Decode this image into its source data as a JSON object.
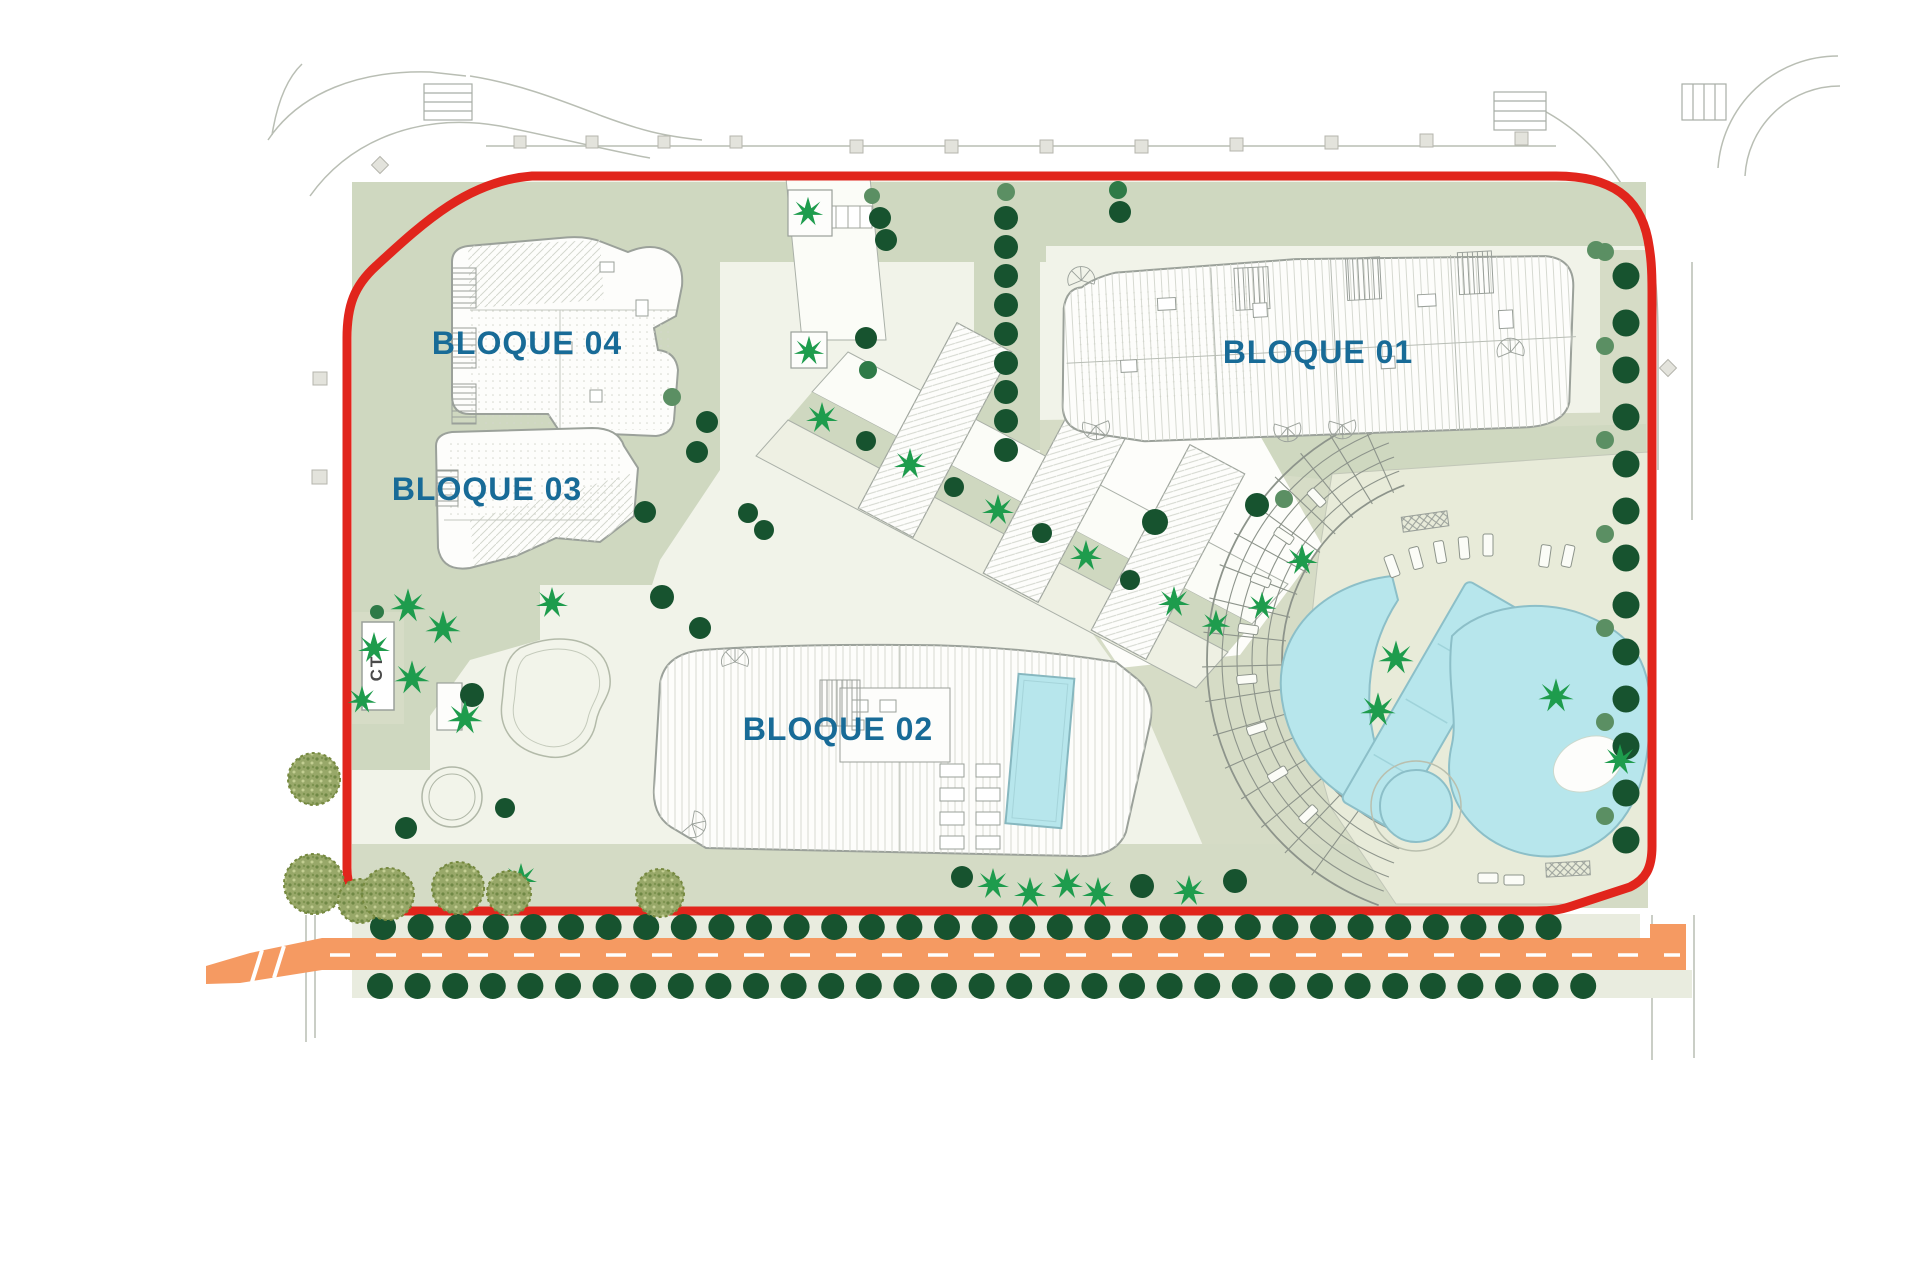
{
  "plan": {
    "blocks": [
      {
        "id": "bloque-01",
        "label": "BLOQUE 01"
      },
      {
        "id": "bloque-02",
        "label": "BLOQUE 02"
      },
      {
        "id": "bloque-03",
        "label": "BLOQUE 03"
      },
      {
        "id": "bloque-04",
        "label": "BLOQUE 04"
      }
    ],
    "annotations": {
      "transformer": "CT"
    },
    "palette": {
      "boundary_red": "#E1251C",
      "label_teal": "#186B97",
      "road_orange": "#F59A62",
      "pool_blue": "#B7E6EC",
      "pool_edge": "#8CBFC8",
      "sage_green": "#CFD8C0",
      "pale_walk": "#EEF0E3",
      "deck_green": "#E8EBD9",
      "tree_dark": "#17532F",
      "tree_mid": "#2E7A47",
      "tree_light": "#5B8F63",
      "palm_green": "#1E9C4D",
      "olive_tree": "#98A869",
      "line_gray": "#9AA09A"
    }
  }
}
